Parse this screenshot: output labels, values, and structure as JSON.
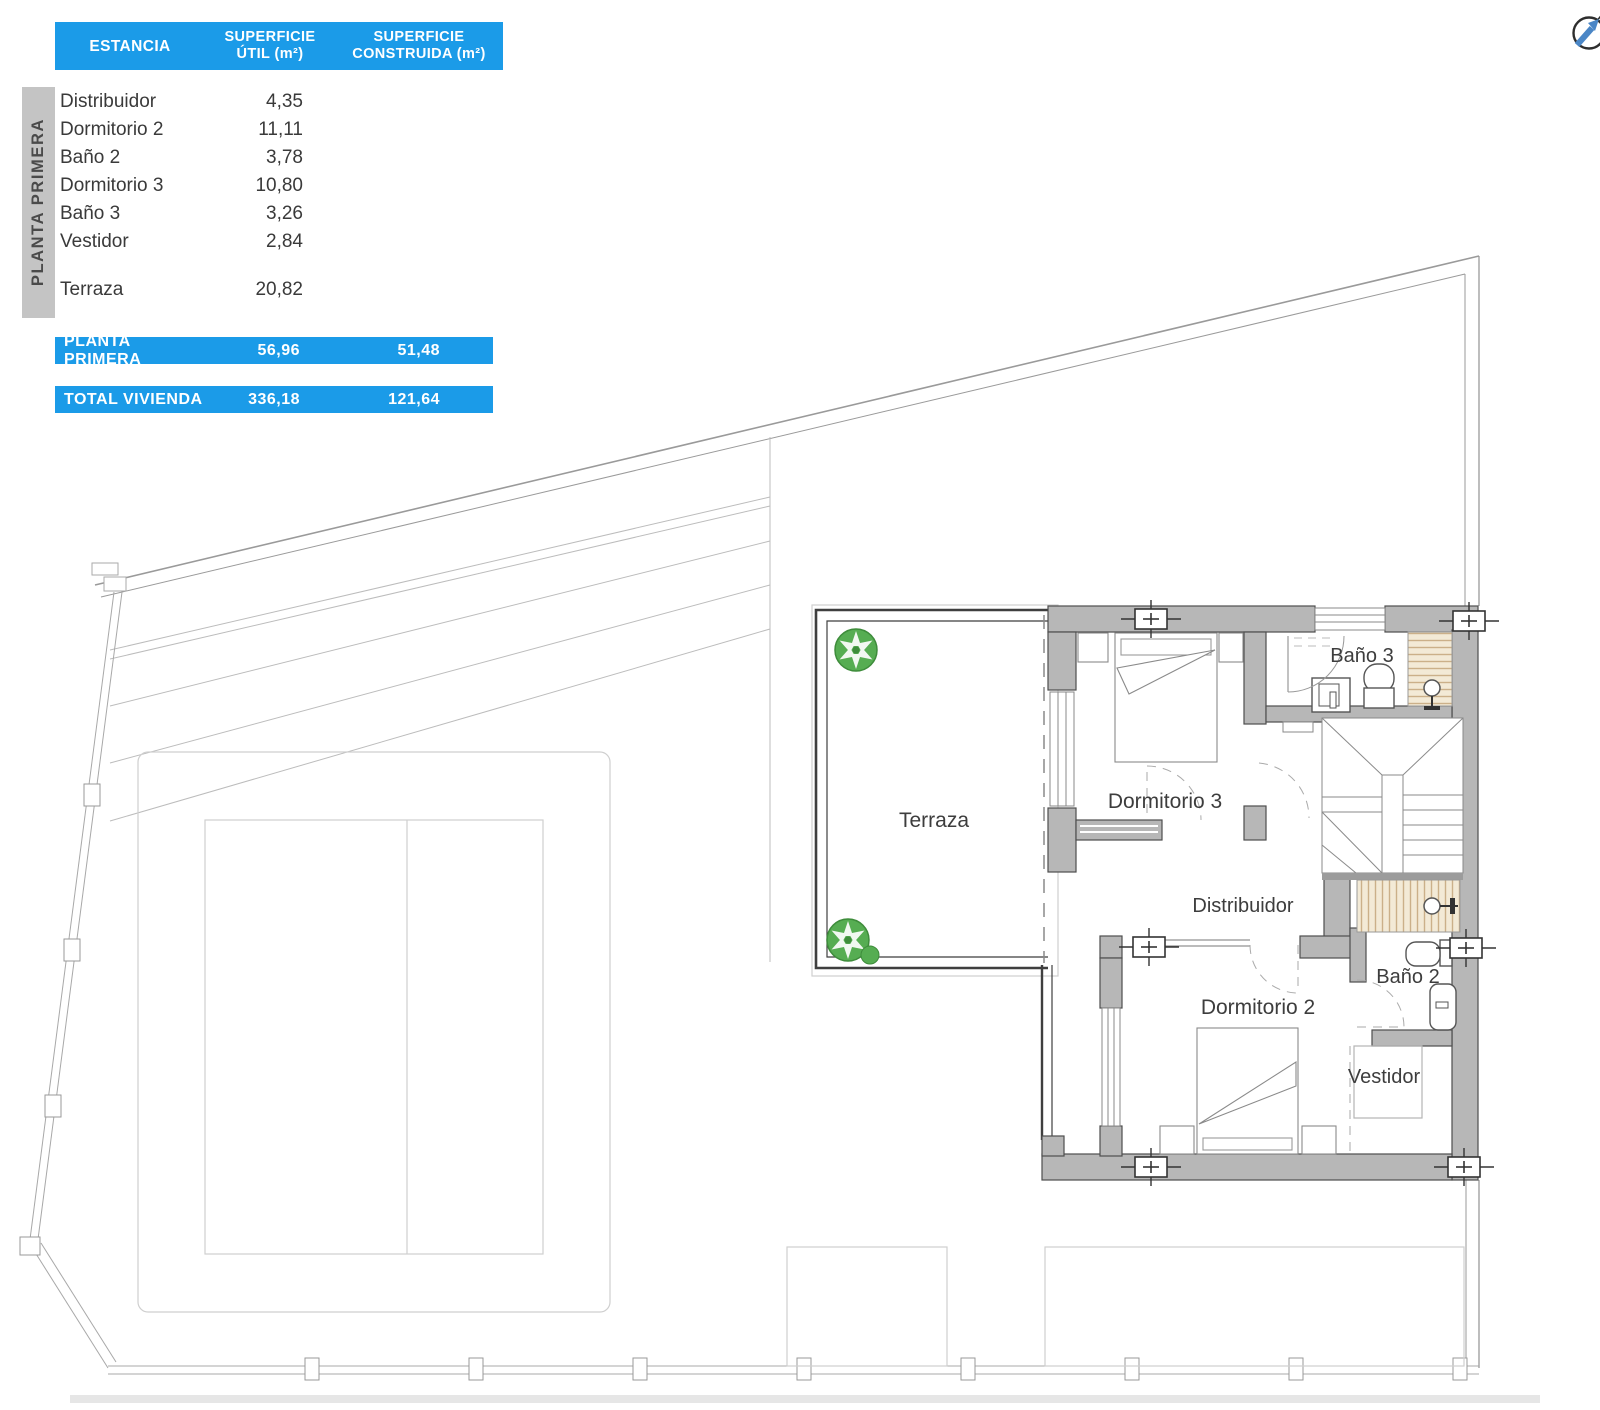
{
  "header_table": {
    "columns": [
      "ESTANCIA",
      "SUPERFICIE\nÚTIL (m²)",
      "SUPERFICIE\nCONSTRUIDA (m²)"
    ],
    "rows": [
      {
        "name": "Distribuidor",
        "util": "4,35"
      },
      {
        "name": "Dormitorio 2",
        "util": "11,11"
      },
      {
        "name": "Baño 2",
        "util": "3,78"
      },
      {
        "name": "Dormitorio 3",
        "util": "10,80"
      },
      {
        "name": "Baño 3",
        "util": "3,26"
      },
      {
        "name": "Vestidor",
        "util": "2,84"
      },
      {
        "name": "Terraza",
        "util": "20,82"
      }
    ],
    "floor_total": {
      "label": "PLANTA PRIMERA",
      "util": "56,96",
      "construida": "51,48"
    },
    "grand_total": {
      "label": "TOTAL VIVIENDA",
      "util": "336,18",
      "construida": "121,64"
    }
  },
  "sidebar": {
    "label": "PLANTA PRIMERA"
  },
  "plan": {
    "rooms": {
      "terraza": "Terraza",
      "dormitorio3": "Dormitorio 3",
      "bano3": "Baño 3",
      "distribuidor": "Distribuidor",
      "dormitorio2": "Dormitorio 2",
      "bano2": "Baño 2",
      "vestidor": "Vestidor"
    }
  },
  "icons": {
    "compass": "north-arrow",
    "tree": "tree",
    "wall_marker": "section-marker"
  },
  "colors": {
    "accent_blue": "#1b9be8",
    "wall_gray": "#b7b7b7",
    "tree_green": "#56ad52",
    "shower_tan": "#f3ead6",
    "line_dark": "#4e4e4e"
  }
}
